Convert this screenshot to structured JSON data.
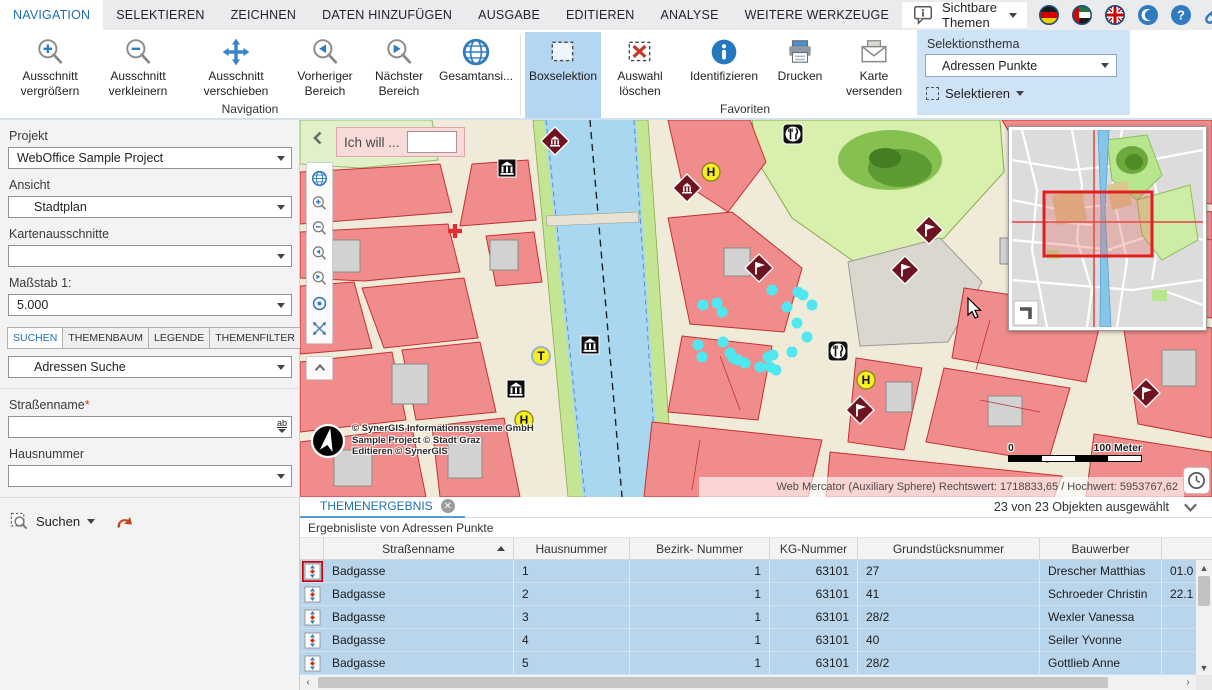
{
  "menubar": {
    "tabs": [
      "NAVIGATION",
      "SELEKTIEREN",
      "ZEICHNEN",
      "DATEN HINZUFÜGEN",
      "AUSGABE",
      "EDITIEREN",
      "ANALYSE",
      "WEITERE WERKZEUGE"
    ],
    "visible_themes": "Sichtbare Themen",
    "icons": [
      "speech-bubble-info",
      "flag-germany",
      "flag-uae",
      "flag-uk",
      "crescent-language",
      "help",
      "link",
      "save-disk",
      "gear",
      "collapse-ribbon"
    ]
  },
  "ribbon": {
    "buttons": [
      {
        "l1": "Ausschnitt",
        "l2": "vergrößern",
        "icon": "zoom-in"
      },
      {
        "l1": "Ausschnitt",
        "l2": "verkleinern",
        "icon": "zoom-out"
      },
      {
        "l1": "Ausschnitt",
        "l2": "verschieben",
        "icon": "pan-arrows"
      },
      {
        "l1": "Vorheriger",
        "l2": "Bereich",
        "icon": "zoom-previous"
      },
      {
        "l1": "Nächster",
        "l2": "Bereich",
        "icon": "zoom-next"
      },
      {
        "l1": "Gesamtansi...",
        "l2": "",
        "icon": "globe"
      },
      {
        "l1": "Boxselektion",
        "l2": "",
        "icon": "selection-box",
        "active": true
      },
      {
        "l1": "Auswahl",
        "l2": "löschen",
        "icon": "clear-selection"
      },
      {
        "l1": "Identifizieren",
        "l2": "",
        "icon": "info"
      },
      {
        "l1": "Drucken",
        "l2": "",
        "icon": "printer"
      },
      {
        "l1": "Karte",
        "l2": "versenden",
        "icon": "envelope"
      }
    ],
    "groups": {
      "navigation": "Navigation",
      "favoriten": "Favoriten"
    },
    "selection_panel": {
      "title": "Selektionsthema",
      "theme": "Adressen Punkte",
      "select_label": "Selektieren"
    }
  },
  "sidebar": {
    "project_label": "Projekt",
    "project_value": "WebOffice Sample Project",
    "view_label": "Ansicht",
    "view_value": "Stadtplan",
    "extents_label": "Kartenausschnitte",
    "extents_value": "",
    "scale_label": "Maßstab 1:",
    "scale_value": "5.000",
    "tabs": [
      "SUCHEN",
      "THEMENBAUM",
      "LEGENDE",
      "THEMENFILTER"
    ],
    "search_theme": "Adressen Suche",
    "street_label": "Straßenname",
    "required_mark": "*",
    "house_label": "Hausnummer",
    "search_label": "Suchen"
  },
  "map": {
    "prompt": "Ich will ...",
    "copyright1": "© SynerGIS Informationssysteme GmbH",
    "copyright2": "Sample Project © Stadt Graz",
    "copyright3": "Editieren © SynerGIS",
    "scale_zero": "0",
    "scale_hundred": "100 Meter",
    "coordinates": "Web Mercator (Auxiliary Sphere) Rechtswert: 1718833,65 / Hochwert: 5953767,62"
  },
  "results": {
    "tab": "THEMENERGEBNIS",
    "status": "23 von 23 Objekten ausgewählt",
    "subtitle": "Ergebnisliste von Adressen Punkte",
    "cols": [
      "Straßenname",
      "Hausnummer",
      "Bezirk- Nummer",
      "KG-Nummer",
      "Grundstücksnummer",
      "Bauwerber"
    ],
    "rows": [
      {
        "strasse": "Badgasse",
        "nr": "1",
        "bezirk": "1",
        "kg": "63101",
        "grund": "27",
        "bauwerber": "Drescher Matthias",
        "datum": "01.0"
      },
      {
        "strasse": "Badgasse",
        "nr": "2",
        "bezirk": "1",
        "kg": "63101",
        "grund": "41",
        "bauwerber": "Schroeder Christin",
        "datum": "22.1"
      },
      {
        "strasse": "Badgasse",
        "nr": "3",
        "bezirk": "1",
        "kg": "63101",
        "grund": "28/2",
        "bauwerber": "Wexler Vanessa",
        "datum": ""
      },
      {
        "strasse": "Badgasse",
        "nr": "4",
        "bezirk": "1",
        "kg": "63101",
        "grund": "40",
        "bauwerber": "Seiler Yvonne",
        "datum": ""
      },
      {
        "strasse": "Badgasse",
        "nr": "5",
        "bezirk": "1",
        "kg": "63101",
        "grund": "28/2",
        "bauwerber": "Gottlieb Anne",
        "datum": ""
      }
    ]
  },
  "colors": {
    "accent_blue": "#1f6fb5",
    "icon_blue": "#2e7bc0",
    "highlight": "#b3d6f2",
    "panel_blue": "#cfe3f6",
    "row_blue": "#b9d5ec",
    "selection_cyan": "#4fe8f0",
    "building_red": "#f18c8c",
    "marker_maroon": "#6d1420"
  }
}
